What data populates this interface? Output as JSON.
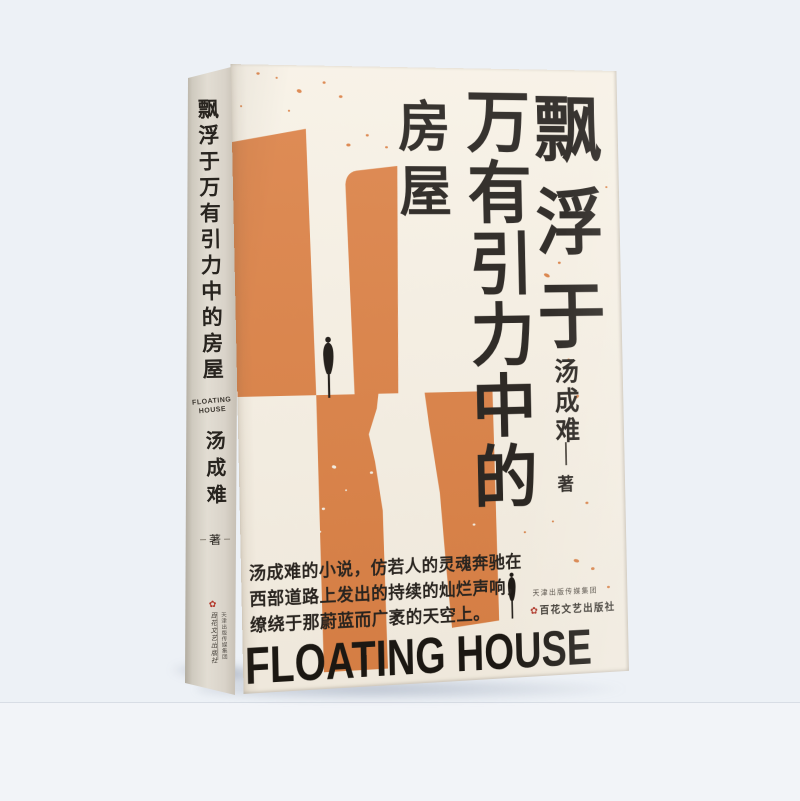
{
  "page": {
    "background": "#edf1f6",
    "surface": "#f3f5f9"
  },
  "icons": {
    "publisher_seal": "✿"
  },
  "book": {
    "colors": {
      "orange": "#db8044",
      "cream": "#f7f1e5",
      "spine_gray": "#d9d4ca",
      "ink": "#221e1a",
      "seal_red": "#b23427"
    },
    "spine": {
      "title": "飘浮于万有引力中的房屋",
      "title_en_line1": "FLOATING",
      "title_en_line2": "HOUSE",
      "author": "汤成难",
      "author_role": "著",
      "publisher_group": "天津出版传媒集团",
      "publisher_name": "百花文艺出版社"
    },
    "cover": {
      "title_col_right": "飘浮于",
      "title_col_middle": "万有引力中的",
      "title_col_left": "房屋",
      "author": "汤成难",
      "author_role": "著",
      "blurb_lines": [
        "汤成难的小说，仿若人的灵魂奔驰在",
        "西部道路上发出的持续的灿烂声响，",
        "缭绕于那蔚蓝而广袤的天空上。"
      ],
      "title_en": "FLOATING HOUSE",
      "publisher_group": "天津出版传媒集团",
      "publisher_name": "百花文艺出版社"
    }
  }
}
